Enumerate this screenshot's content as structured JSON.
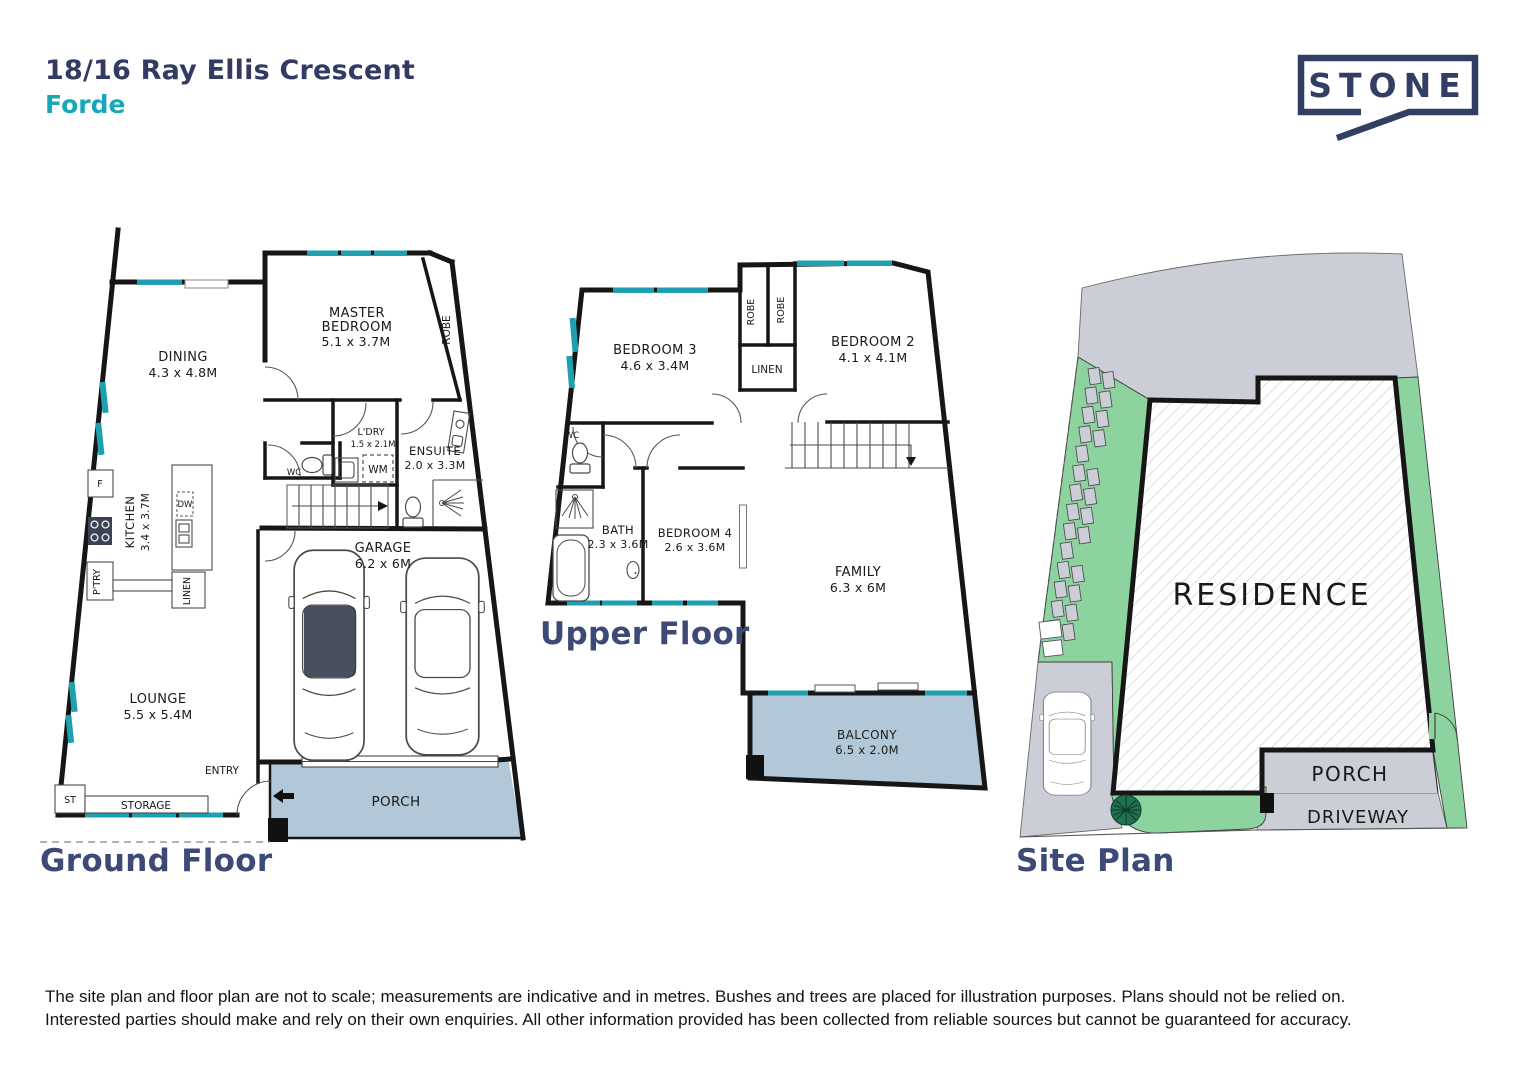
{
  "header": {
    "address": "18/16 Ray Ellis Crescent",
    "suburb": "Forde"
  },
  "logo": {
    "brand": "STONE"
  },
  "ground": {
    "title": "Ground Floor",
    "dining": {
      "name": "DINING",
      "dims": "4.3 x 4.8M"
    },
    "master": {
      "l1": "MASTER",
      "l2": "BEDROOM",
      "dims": "5.1 x 3.7M"
    },
    "robe": "ROBE",
    "ldry": {
      "name": "L'DRY",
      "dims": "1.5 x 2.1M"
    },
    "wm": "WM",
    "dw": "DW",
    "fridge": "F",
    "pantry": "P'TRY",
    "linen": "LINEN",
    "wc": "WC",
    "ensuite": {
      "name": "ENSUITE",
      "dims": "2.0 x 3.3M"
    },
    "kitchen": {
      "name": "KITCHEN",
      "dims": "3.4 x 3.7M"
    },
    "lounge": {
      "name": "LOUNGE",
      "dims": "5.5 x 5.4M"
    },
    "garage": {
      "name": "GARAGE",
      "dims": "6.2 x 6M"
    },
    "entry": "ENTRY",
    "st": "ST",
    "storage": "STORAGE",
    "porch": "PORCH"
  },
  "upper": {
    "title": "Upper Floor",
    "bedroom3": {
      "name": "BEDROOM 3",
      "dims": "4.6 x 3.4M"
    },
    "bedroom2": {
      "name": "BEDROOM 2",
      "dims": "4.1 x 4.1M"
    },
    "bedroom4": {
      "name": "BEDROOM 4",
      "dims": "2.6 x 3.6M"
    },
    "bath": {
      "name": "BATH",
      "dims": "2.3 x 3.6M"
    },
    "family": {
      "name": "FAMILY",
      "dims": "6.3 x 6M"
    },
    "balcony": {
      "name": "BALCONY",
      "dims": "6.5 x 2.0M"
    },
    "robe1": "ROBE",
    "robe2": "ROBE",
    "linen": "LINEN",
    "wc": "WC"
  },
  "site": {
    "title": "Site Plan",
    "residence": "RESIDENCE",
    "porch": "PORCH",
    "driveway": "DRIVEWAY"
  },
  "disclaimer": {
    "line1": "The site plan and floor plan are not to scale; measurements are indicative and in metres. Bushes and trees are placed for illustration purposes. Plans should not be relied on.",
    "line2": "Interested parties should make and rely on their own enquiries. All other information provided has been collected from reliable sources but cannot be guaranteed for accuracy."
  },
  "colors": {
    "navy": "#333b63",
    "teal": "#18a7b7",
    "window_teal": "#1f9fb0",
    "porch_blue": "#b2c8d8",
    "site_green": "#8dd3a0",
    "site_gray": "#cbcdd7",
    "tree_green": "#20714f"
  }
}
